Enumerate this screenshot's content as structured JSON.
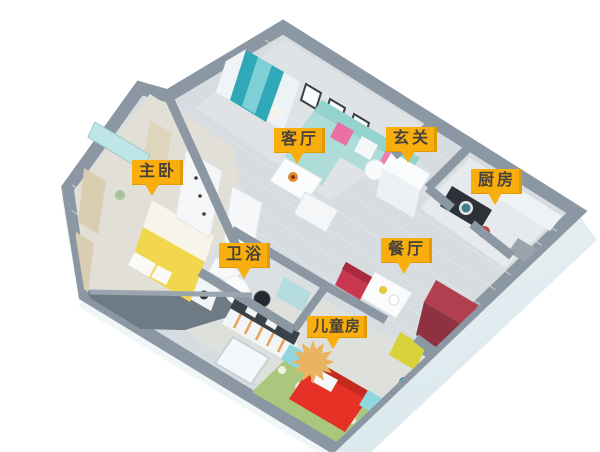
{
  "figure": {
    "type": "3d-floor-plan-render",
    "background": "#ffffff"
  },
  "rooms": [
    {
      "id": "master-bedroom",
      "label": "主卧"
    },
    {
      "id": "living-room",
      "label": "客厅"
    },
    {
      "id": "entryway",
      "label": "玄关"
    },
    {
      "id": "kitchen",
      "label": "厨房"
    },
    {
      "id": "bathroom",
      "label": "卫浴"
    },
    {
      "id": "dining-room",
      "label": "餐厅"
    },
    {
      "id": "kids-room",
      "label": "儿童房"
    }
  ],
  "palette": {
    "label_bg": "#F9AE0D",
    "label_edge": "#E09A08",
    "label_text": "#46413A",
    "wall_top": "#8B97A3",
    "floor_base": "#D6DCE0",
    "living_floor": "#DFE3E5",
    "bedroom_floor": "#E2DFD7",
    "balcony_slate": "#6E7A84",
    "curtain_teal": "#2FA9B8",
    "sofa_teal": "#AEDDD9",
    "bed_yellow": "#F2D74E",
    "kids_bed_red": "#E63226",
    "dining_chair_red": "#C9384E",
    "chair_yellow": "#D8D23A",
    "wardrobe_red": "#B23F4F",
    "nightstand_teal": "#8FD6DE",
    "rug_green": "#A9C77D",
    "starburst": "#E9B45F",
    "cooktop_dark": "#2C3238",
    "kettle_red": "#D0382C"
  }
}
